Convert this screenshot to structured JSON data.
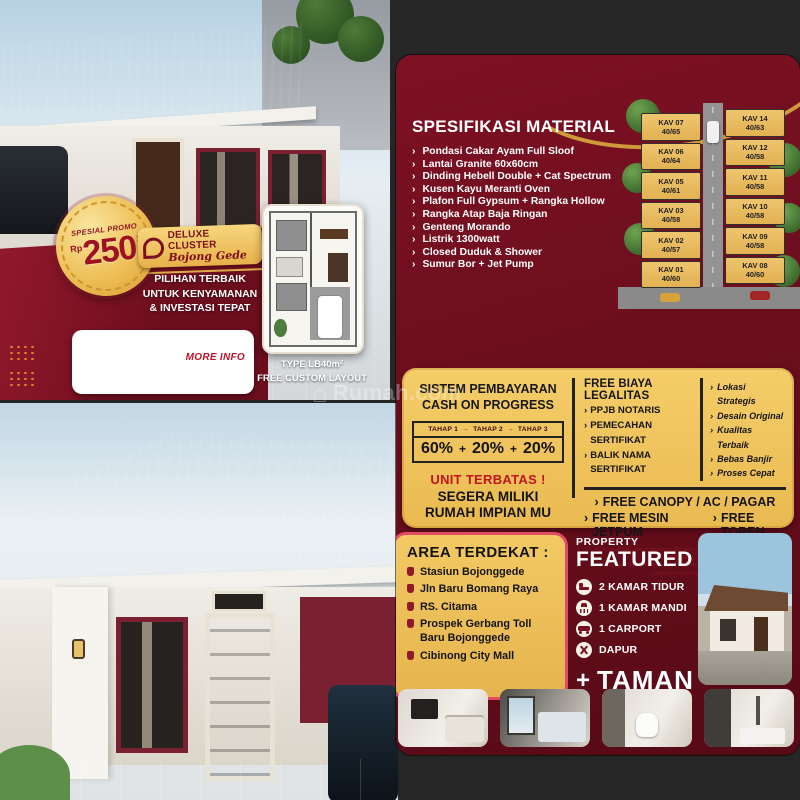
{
  "icons": {
    "chevron": "›",
    "arrow": "→",
    "plus": "+",
    "house": "⌂"
  },
  "watermark": {
    "text": "Rumah.com"
  },
  "promo": {
    "badge_kicker": "SPESIAL PROMO",
    "badge_currency": "Rp",
    "badge_amount": "250",
    "badge_suffix": "JUTAAN",
    "brand_name": "DELUXE CLUSTER",
    "brand_sub": "Bojong Gede",
    "tagline_lines": [
      "PILIHAN TERBAIK",
      "UNTUK KENYAMANAN",
      "& INVESTASI TEPAT"
    ],
    "more_info": "MORE INFO",
    "floorplan_type": "TYPE LB40m²",
    "floorplan_note": "FREE CUSTOM LAYOUT"
  },
  "spec": {
    "title": "SPESIFIKASI MATERIAL",
    "items": [
      "Pondasi Cakar Ayam Full Sloof",
      "Lantai Granite 60x60cm",
      "Dinding Hebell Double + Cat Spectrum",
      "Kusen Kayu Meranti Oven",
      "Plafon Full Gypsum + Rangka Hollow",
      "Rangka Atap Baja Ringan",
      "Genteng Morando",
      "Listrik 1300watt",
      "Closed Duduk & Shower",
      "Sumur Bor + Jet Pump"
    ]
  },
  "siteplan": {
    "left_lots": [
      {
        "kav": "KAV 07",
        "size": "40/65"
      },
      {
        "kav": "KAV 06",
        "size": "40/64"
      },
      {
        "kav": "KAV 05",
        "size": "40/61"
      },
      {
        "kav": "KAV 03",
        "size": "40/58"
      },
      {
        "kav": "KAV 02",
        "size": "40/57"
      },
      {
        "kav": "KAV 01",
        "size": "40/60"
      }
    ],
    "right_lots": [
      {
        "kav": "KAV 14",
        "size": "40/63"
      },
      {
        "kav": "KAV 12",
        "size": "40/58"
      },
      {
        "kav": "KAV 11",
        "size": "40/58"
      },
      {
        "kav": "KAV 10",
        "size": "40/58"
      },
      {
        "kav": "KAV 09",
        "size": "40/58"
      },
      {
        "kav": "KAV 08",
        "size": "40/60"
      }
    ]
  },
  "payment": {
    "title1": "SISTEM PEMBAYARAN",
    "title2": "CASH ON PROGRESS",
    "stages": [
      "TAHAP 1",
      "TAHAP 2",
      "TAHAP 3"
    ],
    "percents": [
      "60%",
      "20%",
      "20%"
    ],
    "limited": "UNIT TERBATAS !",
    "cta1": "SEGERA MILIKI",
    "cta2": "RUMAH IMPIAN MU"
  },
  "legal": {
    "title": "FREE BIAYA LEGALITAS",
    "items": [
      "PPJB NOTARIS",
      "PEMECAHAN SERTIFIKAT",
      "BALIK NAMA SERTIFIKAT"
    ]
  },
  "advantages": {
    "items": [
      "Lokasi Strategis",
      "Desain Original",
      "Kualitas Terbaik",
      "Bebas Banjir",
      "Proses Cepat"
    ]
  },
  "freebies": {
    "line1": "FREE CANOPY / AC / PAGAR",
    "item2": "FREE MESIN JETPUM",
    "item3": "FREE TOREN",
    "fine1": "★ Persyaratan dan Ketentuan Berlaku Sesuai Approval Owner - Staff Marketing ★",
    "fine2": "★ Gambar hanya merupakan Graphic Visual sebagai Pengukuran Capaian Pembangunan ★"
  },
  "area": {
    "title": "AREA TERDEKAT :",
    "items": [
      "Stasiun Bojonggede",
      "Jln Baru Bomang Raya",
      "RS. Citama",
      "Prospek Gerbang Toll Baru Bojonggede",
      "Cibinong City Mall"
    ]
  },
  "featured": {
    "kicker": "PROPERTY",
    "title": "FEATURED",
    "items": [
      {
        "label": "2 KAMAR TIDUR"
      },
      {
        "label": "1 KAMAR MANDI"
      },
      {
        "label": "1 CARPORT"
      },
      {
        "label": "DAPUR"
      }
    ],
    "plus_label": "TAMAN"
  },
  "colors": {
    "maroon": "#6b0e1d",
    "gold": "#eec05a",
    "accent_red": "#c41422"
  }
}
